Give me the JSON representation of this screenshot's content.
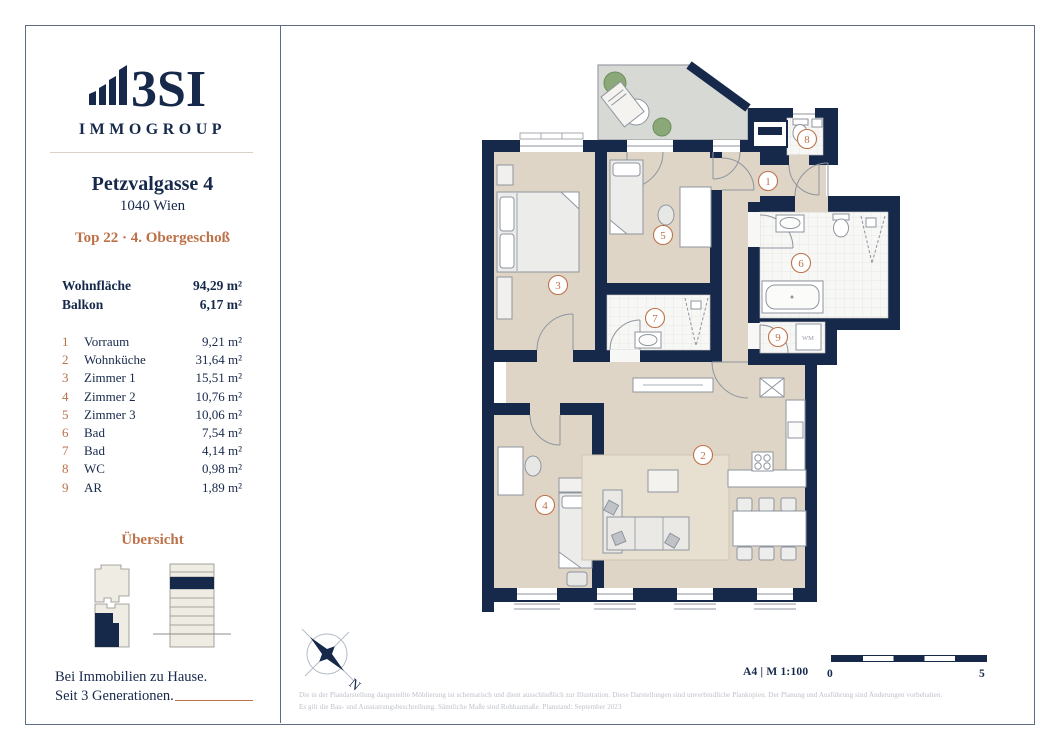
{
  "brand": {
    "logo_text": "3SI",
    "logo_sub": "IMMOGROUP"
  },
  "address": {
    "street": "Petzvalgasse 4",
    "city": "1040 Wien",
    "unit": "Top 22 · 4. Obergeschoß"
  },
  "areas": [
    {
      "label": "Wohnfläche",
      "value": "94,29 m²"
    },
    {
      "label": "Balkon",
      "value": "6,17 m²"
    }
  ],
  "rooms": [
    {
      "nr": "1",
      "name": "Vorraum",
      "area": "9,21 m²"
    },
    {
      "nr": "2",
      "name": "Wohnküche",
      "area": "31,64 m²"
    },
    {
      "nr": "3",
      "name": "Zimmer 1",
      "area": "15,51 m²"
    },
    {
      "nr": "4",
      "name": "Zimmer 2",
      "area": "10,76 m²"
    },
    {
      "nr": "5",
      "name": "Zimmer 3",
      "area": "10,06 m²"
    },
    {
      "nr": "6",
      "name": "Bad",
      "area": "7,54 m²"
    },
    {
      "nr": "7",
      "name": "Bad",
      "area": "4,14 m²"
    },
    {
      "nr": "8",
      "name": "WC",
      "area": "0,98 m²"
    },
    {
      "nr": "9",
      "name": "AR",
      "area": "1,89 m²"
    }
  ],
  "overview": {
    "title": "Übersicht"
  },
  "tagline": {
    "line1": "Bei Immobilien zu Hause.",
    "line2": "Seit 3 Generationen."
  },
  "plan": {
    "wm_label": "WM",
    "compass_n": "N"
  },
  "footer": {
    "scale_note": "A4 | M 1:100",
    "scale_zero": "0",
    "scale_five": "5",
    "disclaimer_line1": "Die in der Plandarstellung dargestellte Möblierung ist schematisch und dient ausschließlich zur Illustration. Diese Darstellungen sind unverbindliche Plankopien. Der Planung und Ausführung sind Änderungen vorbehalten.",
    "disclaimer_line2": "Es gilt die Bau- und Ausstattungsbeschreibung. Sämtliche Maße sind Rohbaumaße. Planstand: September 2023"
  },
  "colors": {
    "navy": "#17294b",
    "copper": "#bd7149",
    "floor": "#ded5c6",
    "balcony": "#d7d9d4",
    "frame": "#5d6c85"
  }
}
